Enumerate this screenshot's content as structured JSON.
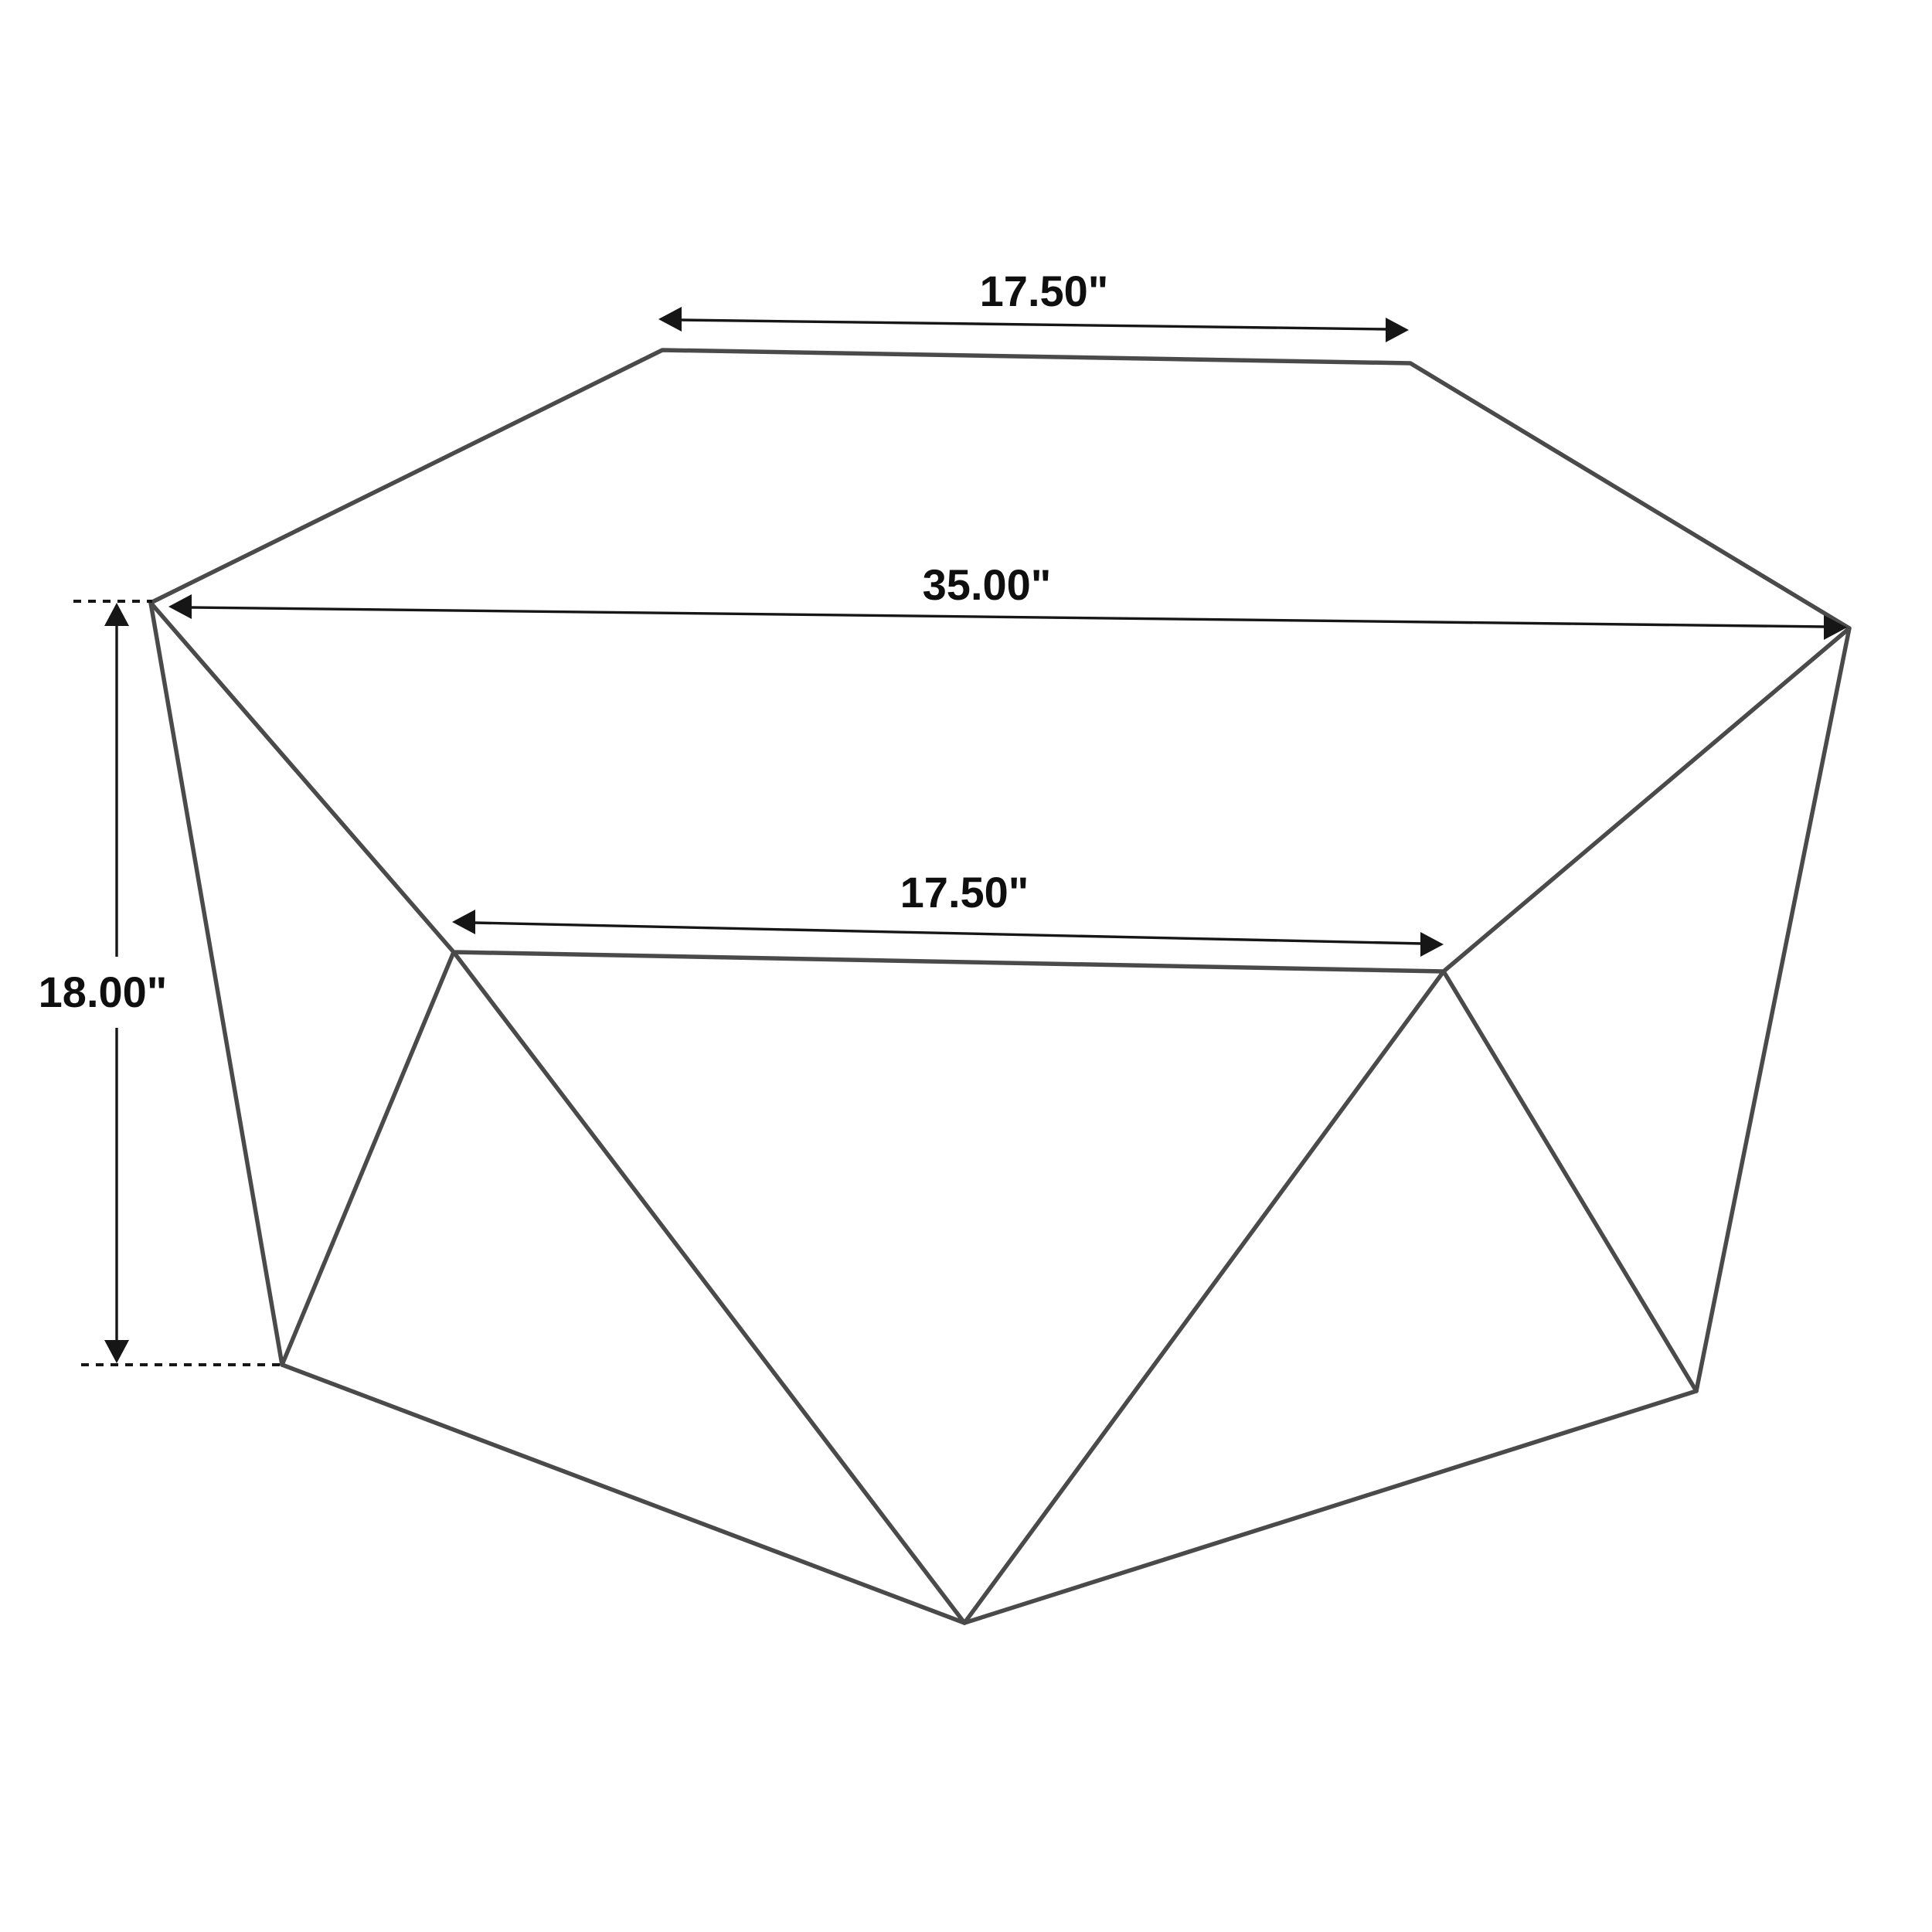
{
  "diagram": {
    "colors": {
      "background": "#ffffff",
      "edge": "#4a4a4a",
      "dimension": "#161616",
      "text": "#0f0f0f"
    },
    "dimensions": {
      "top_width": {
        "label": "17.50\"",
        "value_inches": 17.5
      },
      "overall_width": {
        "label": "35.00\"",
        "value_inches": 35.0
      },
      "front_width": {
        "label": "17.50\"",
        "value_inches": 17.5
      },
      "height": {
        "label": "18.00\"",
        "value_inches": 18.0
      }
    }
  }
}
